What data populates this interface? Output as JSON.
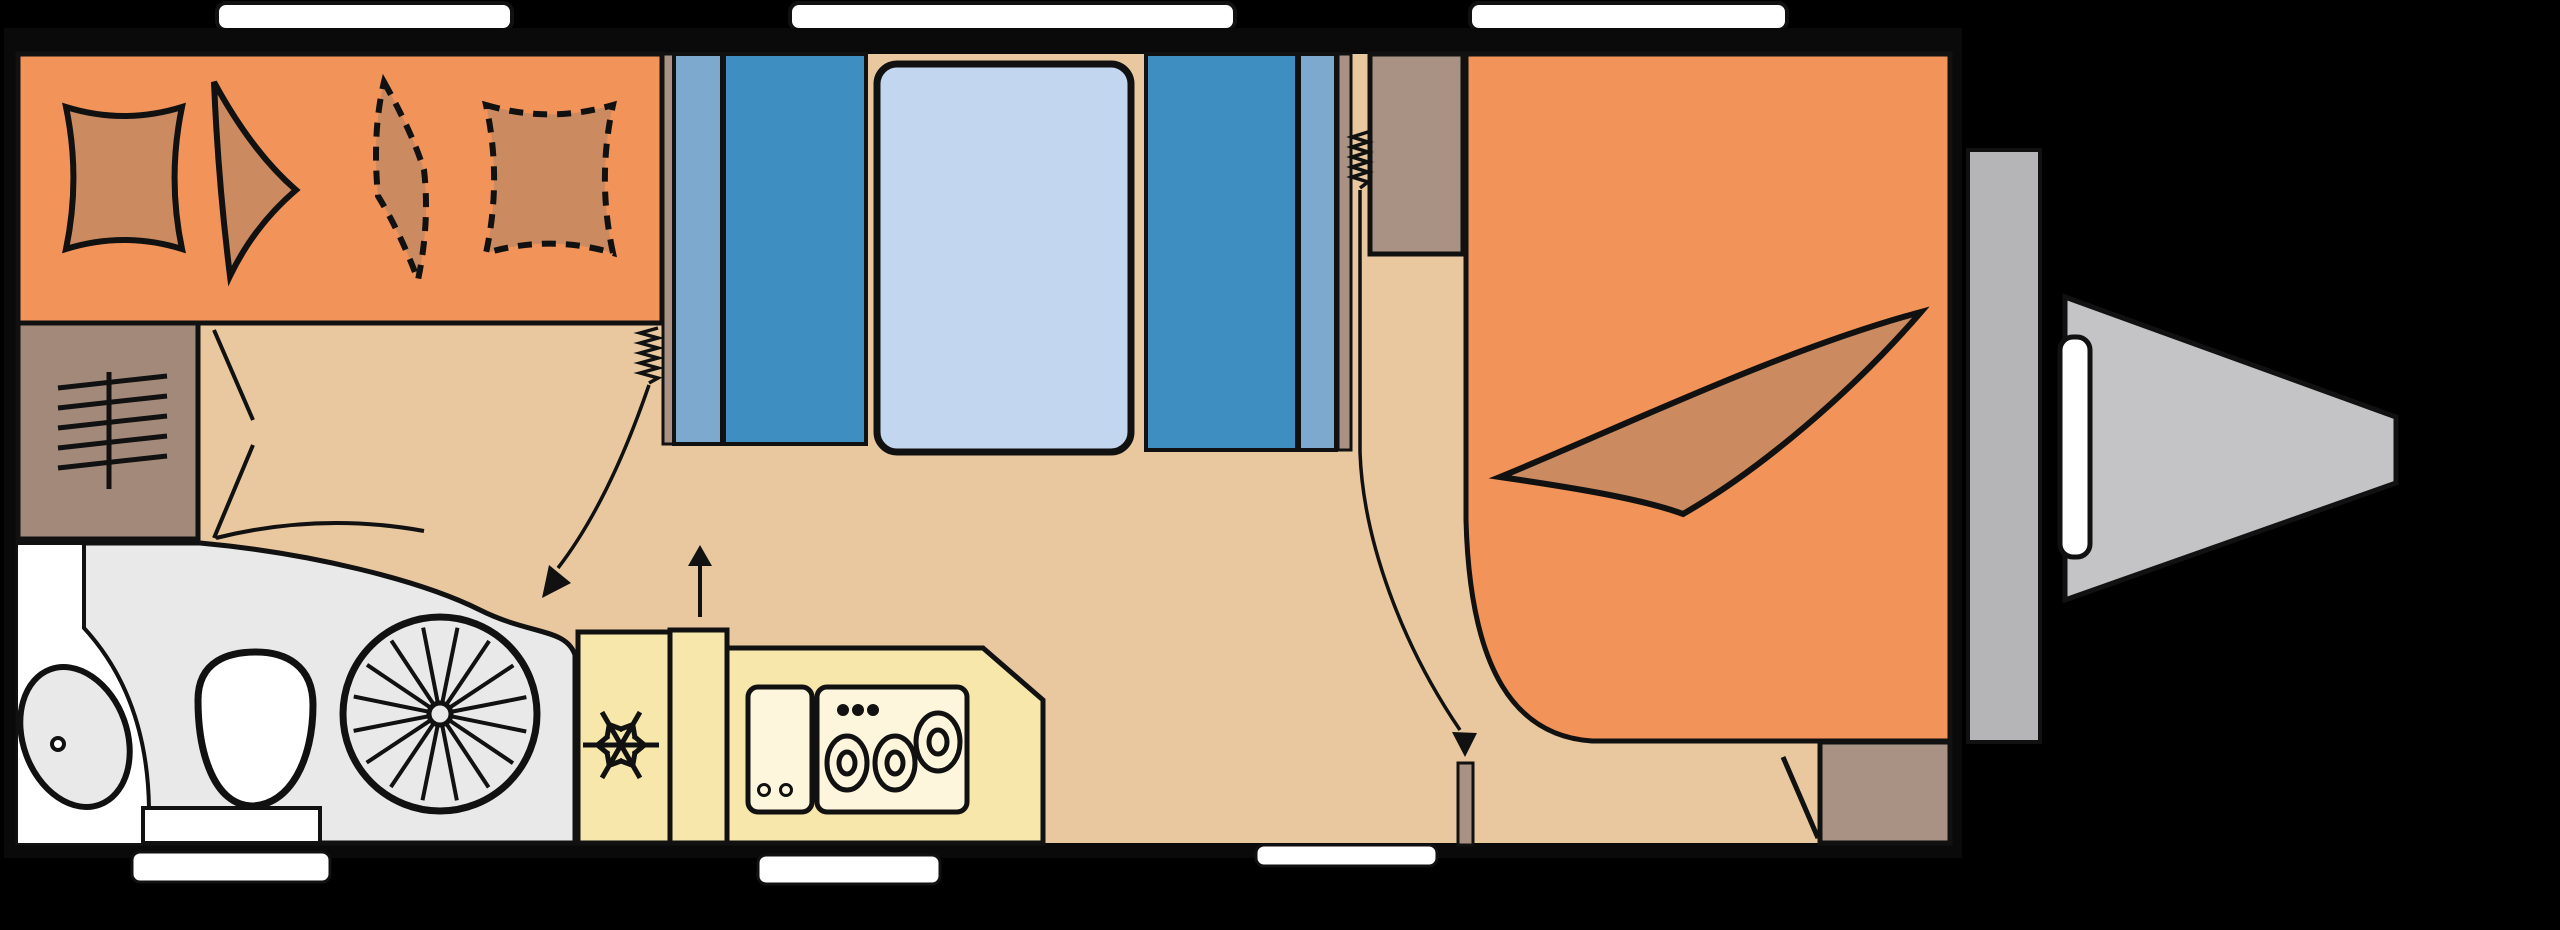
{
  "diagram": {
    "type": "caravan-floor-plan",
    "view": "top-down",
    "palette": {
      "background": "#000000",
      "wall": "#0a0a0a",
      "floor": "#e9c8a0",
      "orange": "#f2935a",
      "cushion": "#cb8a60",
      "heater_brown": "#a3897a",
      "taupe": "#a99283",
      "blue_dark": "#3f8ec2",
      "blue_light": "#7ea9cf",
      "mattress": "#c3d6ef",
      "bath_gray": "#e9e9e9",
      "white": "#ffffff",
      "kitchen_yellow": "#f7e7ab",
      "counter_pale": "#fdf6dd",
      "bumper_gray": "#b5b5b8",
      "drawbar_gray": "#c4c4c6",
      "line": "#111111"
    },
    "roof_vents": [
      {
        "x": 217,
        "w": 295
      },
      {
        "x": 790,
        "w": 445
      },
      {
        "x": 1470,
        "w": 317
      }
    ],
    "entry_steps": [
      {
        "x": 132,
        "y": 852,
        "w": 198,
        "h": 30
      },
      {
        "x": 758,
        "y": 855,
        "w": 182,
        "h": 29
      },
      {
        "x": 1256,
        "y": 845,
        "w": 181,
        "h": 21
      }
    ],
    "cushions": [
      {
        "name": "dinette-seat-cushion",
        "x": 62,
        "y": 103,
        "w": 124,
        "h": 150,
        "style": "solid"
      },
      {
        "name": "dinette-optional-cushion",
        "x": 482,
        "y": 101,
        "w": 135,
        "h": 156,
        "style": "dashed"
      },
      {
        "name": "bed-pillow-left",
        "x": 1518,
        "y": 103,
        "w": 172,
        "h": 168,
        "style": "solid"
      },
      {
        "name": "bed-pillow-right",
        "x": 1737,
        "y": 105,
        "w": 168,
        "h": 166,
        "style": "solid"
      }
    ],
    "wheel": {
      "spokes": 16
    },
    "snowflake": {
      "arms": 6
    },
    "hob": {
      "burners": 3,
      "knob_dots": 3
    },
    "sink": {
      "dots": 2
    },
    "zones": [
      {
        "id": "dinette",
        "name": "front-dinette-seating"
      },
      {
        "id": "heater",
        "name": "heater-cabinet"
      },
      {
        "id": "bathroom",
        "name": "washroom-with-wheel-arch"
      },
      {
        "id": "bunks",
        "name": "transverse-bunk-beds"
      },
      {
        "id": "kitchen",
        "name": "kitchen-with-fridge-sink-hob"
      },
      {
        "id": "wardrobe",
        "name": "wardrobe"
      },
      {
        "id": "bed",
        "name": "rear-double-bed"
      },
      {
        "id": "drawbar",
        "name": "a-frame-drawbar"
      }
    ]
  }
}
